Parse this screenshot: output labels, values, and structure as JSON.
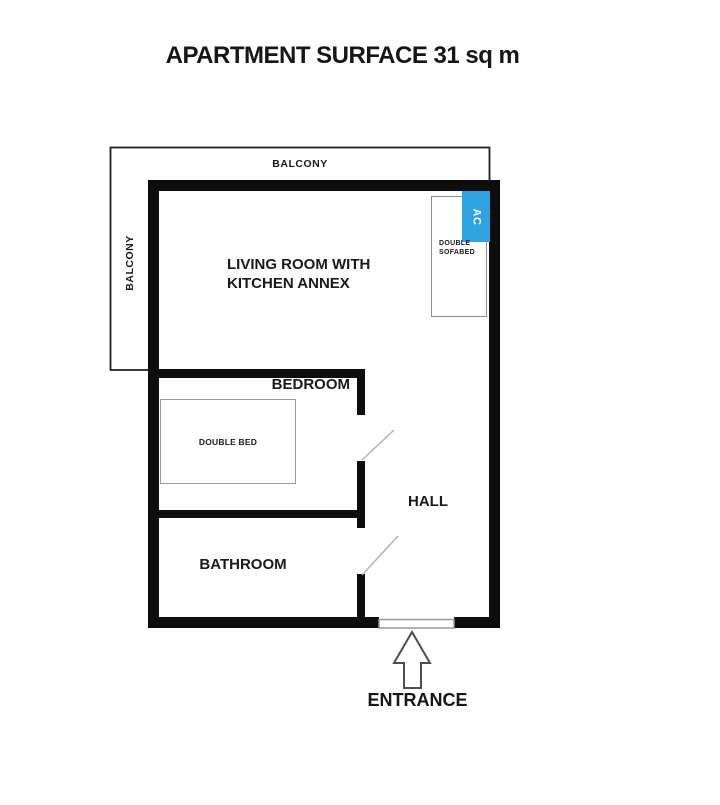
{
  "title": "APARTMENT SURFACE 31 sq m",
  "colors": {
    "wall": "#0d0d0d",
    "ac_blue": "#2ea3df",
    "furniture_border": "#8c8c8c",
    "door_swing_line": "#b3b3b3"
  },
  "rooms": {
    "living_room_line1": "LIVING ROOM WITH",
    "living_room_line2": "KITCHEN ANNEX",
    "bedroom": "BEDROOM",
    "bathroom": "BATHROOM",
    "hall": "HALL"
  },
  "outdoor": {
    "balcony_top": "BALCONY",
    "balcony_left": "BALCONY"
  },
  "furniture": {
    "ac_unit": "AC",
    "sofabed_line1": "DOUBLE",
    "sofabed_line2": "SOFABED",
    "double_bed": "DOUBLE BED"
  },
  "entrance": {
    "label": "ENTRANCE"
  }
}
